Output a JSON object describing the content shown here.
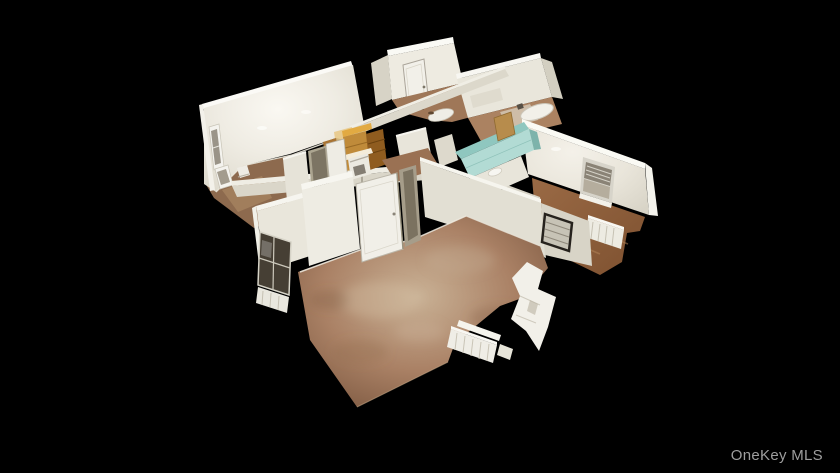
{
  "window": {
    "width": 840,
    "height": 473,
    "background_color": "#000000"
  },
  "watermark": {
    "text": "OneKey MLS",
    "color": "#9e9e9e",
    "position": "bottom-right"
  },
  "scene": {
    "type": "3d-dollhouse-floorplan",
    "description": "Overhead cutaway Matterport-style dollhouse view of an empty apartment with white walls and brown floors on a black background",
    "palette": {
      "background": "#000000",
      "wall_light": "#f2efe7",
      "wall_shadow": "#d7d3c6",
      "wall_edge_highlight": "#fafaf4",
      "carpet_floor": "#a98266",
      "carpet_hotspot": "#c9b195",
      "wood_floor": "#94633f",
      "kitchen_cabinet_wood": "#c08b3a",
      "kitchen_cabinet_dark": "#8f5c1f",
      "bathroom_tile_teal": "#8fc7bf",
      "window_glass_dark": "#463f34"
    },
    "rooms": [
      {
        "name": "bedroom-upper-left",
        "features": [
          "two windows",
          "carpet floor"
        ]
      },
      {
        "name": "entry-hall",
        "features": [
          "entry door"
        ]
      },
      {
        "name": "bathroom-top",
        "features": [
          "bathtub",
          "tile floor"
        ]
      },
      {
        "name": "kitchen",
        "features": [
          "wood cabinets",
          "stove"
        ]
      },
      {
        "name": "bathroom-middle",
        "features": [
          "teal tile wall",
          "sink"
        ]
      },
      {
        "name": "bedroom-right",
        "features": [
          "window with blinds",
          "radiator",
          "wood floor"
        ]
      },
      {
        "name": "bedroom-lower-left",
        "features": [
          "bay window",
          "radiator"
        ]
      },
      {
        "name": "living-room",
        "features": [
          "open door",
          "carpet floor",
          "radiator",
          "cut wall sections"
        ]
      }
    ]
  }
}
